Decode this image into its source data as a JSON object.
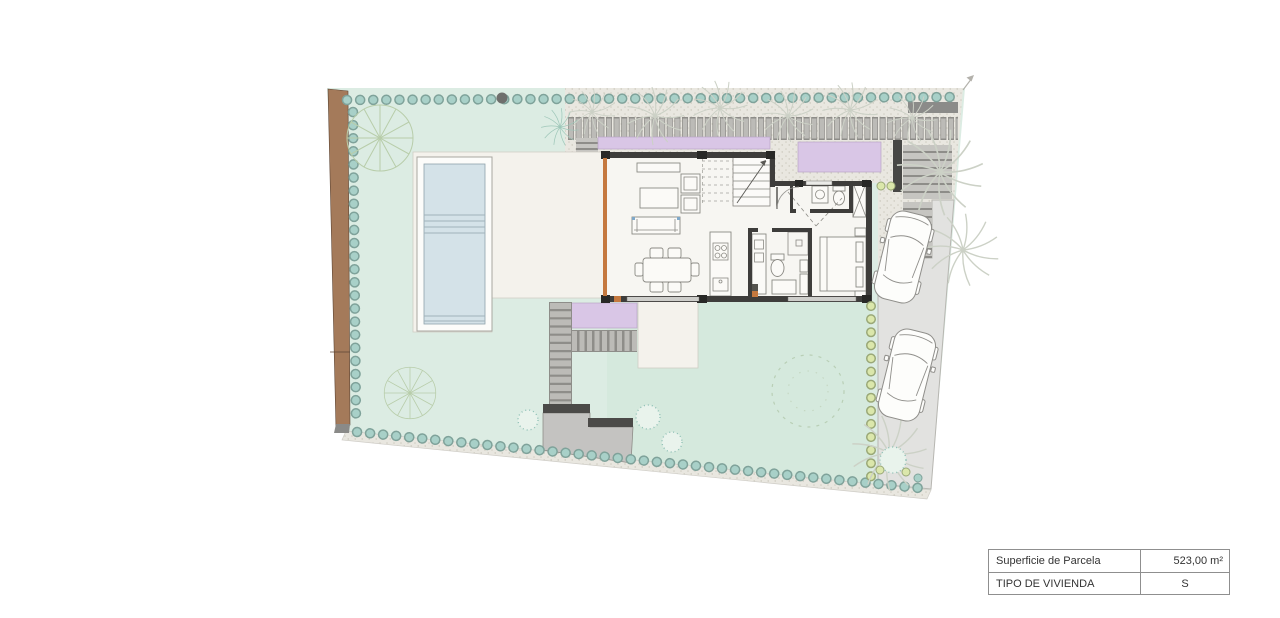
{
  "summary_table": {
    "rows": [
      {
        "label": "Superficie de Parcela",
        "value": "523,00 m²"
      },
      {
        "label": "TIPO DE VIVIENDA",
        "value": "S"
      }
    ]
  },
  "colors": {
    "lawn": "#dcece3",
    "lawn-south": "#d5e9dd",
    "pool-water": "#d4e2e8",
    "terrace": "#f4f2ec",
    "floor": "#f7f6f2",
    "concrete": "#e9e7e0",
    "driveway": "#e2e2e0",
    "lavender": "#d9c6e6",
    "slat": "#bcbbb7",
    "slat-dark": "#8e8d89",
    "boundary-wall": "#a47a5a",
    "house-wall": "#3e3d3b",
    "hedge-teal-outline": "#7fa29a",
    "hedge-teal-fill": "#a8d0c8",
    "hedge-green-outline": "#9aa877",
    "hedge-green-fill": "#dbe7ab",
    "tree-stroke": "#b8cdaa",
    "palm-stroke": "#ccd1c6",
    "accent-orange": "#c5793f",
    "furniture-stroke": "#8b8a84",
    "car-stroke": "#8f8e8a",
    "pool-line": "#9fb2ba"
  }
}
